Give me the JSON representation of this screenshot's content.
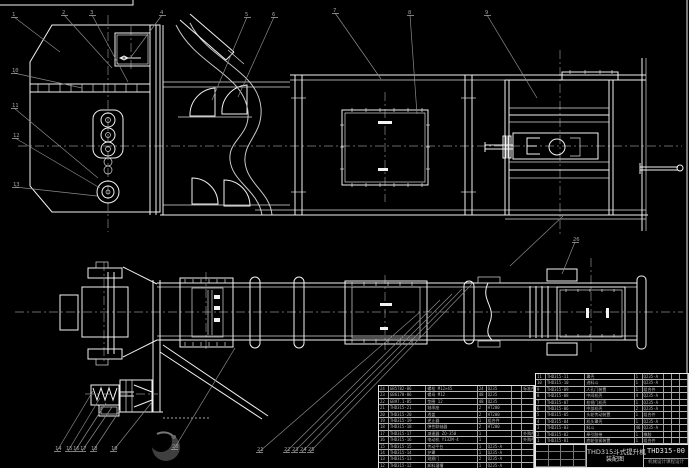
{
  "drawing": {
    "title_line1": "THD315斗式提升机",
    "title_line2": "装配图",
    "drawing_number": "THD315-00",
    "subtitle": "机械设计课程设计",
    "colors": {
      "background": "#000000",
      "main_line": "#f2f2f2",
      "aux_line": "#8c8c8c"
    }
  },
  "bom_right": {
    "headers": [
      "序号",
      "代 号",
      "名 称",
      "数量",
      "材 料",
      "单件",
      "总计",
      "备注"
    ],
    "rows": [
      [
        "11",
        "THD315-11",
        "罩壳",
        "1",
        "Q235-A",
        "",
        "",
        ""
      ],
      [
        "10",
        "THD315-10",
        "进料斗",
        "1",
        "Q235-A",
        "",
        "",
        ""
      ],
      [
        "9",
        "THD315-09",
        "人孔门装置",
        "1",
        "组合件",
        "",
        "",
        ""
      ],
      [
        "8",
        "THD315-08",
        "中间机壳",
        "4",
        "Q235-A",
        "",
        "",
        ""
      ],
      [
        "7",
        "THD315-07",
        "检视门机壳",
        "1",
        "Q235-A",
        "",
        "",
        ""
      ],
      [
        "6",
        "THD315-06",
        "中部机壳",
        "2",
        "Q235-A",
        "",
        "",
        ""
      ],
      [
        "5",
        "THD315-05",
        "头轮传动装置",
        "1",
        "组合件",
        "",
        "",
        ""
      ],
      [
        "4",
        "THD315-04",
        "机头罩壳",
        "1",
        "Q235-A",
        "",
        "",
        ""
      ],
      [
        "3",
        "THD315-03",
        "料斗",
        "46",
        "Q235-A",
        "",
        "",
        ""
      ],
      [
        "2",
        "THD315-02",
        "牵引胶带",
        "1",
        "橡胶",
        "",
        "",
        ""
      ],
      [
        "1",
        "THD315-01",
        "底轮张紧装置",
        "1",
        "组合件",
        "",
        "",
        ""
      ]
    ],
    "widths": [
      10,
      40,
      50,
      8,
      22,
      8,
      8,
      8
    ]
  },
  "bom_left": {
    "rows": [
      [
        "24",
        "GB5782-86",
        "螺栓 M12×45",
        "24",
        "Q235",
        "",
        "标准件"
      ],
      [
        "23",
        "GB6170-86",
        "螺母 M12",
        "48",
        "Q235",
        "",
        ""
      ],
      [
        "22",
        "GB97.1-85",
        "垫圈 12",
        "48",
        "Q235",
        "",
        ""
      ],
      [
        "21",
        "THD315-21",
        "轴承座",
        "2",
        "HT200",
        "",
        ""
      ],
      [
        "20",
        "THD315-20",
        "透盖",
        "2",
        "HT200",
        "",
        ""
      ],
      [
        "19",
        "THD315-19",
        "逆止器",
        "1",
        "组合件",
        "",
        ""
      ],
      [
        "18",
        "THD315-18",
        "弹性联轴器",
        "2",
        "HT200",
        "",
        ""
      ],
      [
        "17",
        "THD315-17",
        "减速器 ZQ-350",
        "1",
        "",
        "",
        "外购件"
      ],
      [
        "16",
        "THD315-16",
        "电动机 Y132M-4",
        "1",
        "",
        "",
        "外购件"
      ],
      [
        "15",
        "THD315-15",
        "传动平台",
        "1",
        "Q235-A",
        "",
        ""
      ],
      [
        "14",
        "THD315-14",
        "护罩",
        "1",
        "Q235-A",
        "",
        ""
      ],
      [
        "13",
        "THD315-13",
        "观察门",
        "2",
        "Q235-A",
        "",
        ""
      ],
      [
        "12",
        "THD315-12",
        "卸料溜槽",
        "1",
        "Q235-A",
        "",
        ""
      ]
    ],
    "widths": [
      10,
      38,
      52,
      9,
      26,
      10,
      12
    ]
  },
  "balloons": [
    {
      "n": "1",
      "x": 12,
      "y": 12,
      "tx": 60,
      "ty": 52
    },
    {
      "n": "2",
      "x": 62,
      "y": 10,
      "tx": 112,
      "ty": 68
    },
    {
      "n": "3",
      "x": 90,
      "y": 10,
      "tx": 128,
      "ty": 82
    },
    {
      "n": "4",
      "x": 160,
      "y": 10,
      "tx": 131,
      "ty": 57
    },
    {
      "n": "5",
      "x": 245,
      "y": 12,
      "tx": 212,
      "ty": 100
    },
    {
      "n": "6",
      "x": 272,
      "y": 12,
      "tx": 238,
      "ty": 97
    },
    {
      "n": "7",
      "x": 333,
      "y": 8,
      "tx": 381,
      "ty": 79
    },
    {
      "n": "8",
      "x": 408,
      "y": 10,
      "tx": 417,
      "ty": 114
    },
    {
      "n": "9",
      "x": 485,
      "y": 10,
      "tx": 537,
      "ty": 98
    },
    {
      "n": "10",
      "x": 12,
      "y": 68,
      "tx": 82,
      "ty": 88
    },
    {
      "n": "11",
      "x": 12,
      "y": 103,
      "tx": 98,
      "ty": 178
    },
    {
      "n": "12",
      "x": 13,
      "y": 133,
      "tx": 100,
      "ty": 188
    },
    {
      "n": "13",
      "x": 13,
      "y": 182,
      "tx": 97,
      "ty": 196
    },
    {
      "n": "14",
      "x": 55,
      "y": 446,
      "tx": 93,
      "ty": 391
    },
    {
      "n": "15",
      "x": 66,
      "y": 446,
      "tx": 100,
      "ty": 398
    },
    {
      "n": "16",
      "x": 73,
      "y": 446,
      "tx": 106,
      "ty": 403
    },
    {
      "n": "17",
      "x": 80,
      "y": 446,
      "tx": 112,
      "ty": 407
    },
    {
      "n": "18",
      "x": 91,
      "y": 446,
      "tx": 120,
      "ty": 410
    },
    {
      "n": "19",
      "x": 111,
      "y": 446,
      "tx": 152,
      "ty": 402
    },
    {
      "n": "20",
      "x": 172,
      "y": 444,
      "tx": 235,
      "ty": 348
    },
    {
      "n": "21",
      "x": 257,
      "y": 447,
      "tx": 420,
      "ty": 312
    },
    {
      "n": "22",
      "x": 284,
      "y": 447,
      "tx": 440,
      "ty": 300
    },
    {
      "n": "23",
      "x": 292,
      "y": 447,
      "tx": 452,
      "ty": 294
    },
    {
      "n": "24",
      "x": 300,
      "y": 447,
      "tx": 462,
      "ty": 289
    },
    {
      "n": "25",
      "x": 308,
      "y": 447,
      "tx": 472,
      "ty": 284
    },
    {
      "n": "26",
      "x": 573,
      "y": 237,
      "tx": 562,
      "ty": 274
    }
  ]
}
